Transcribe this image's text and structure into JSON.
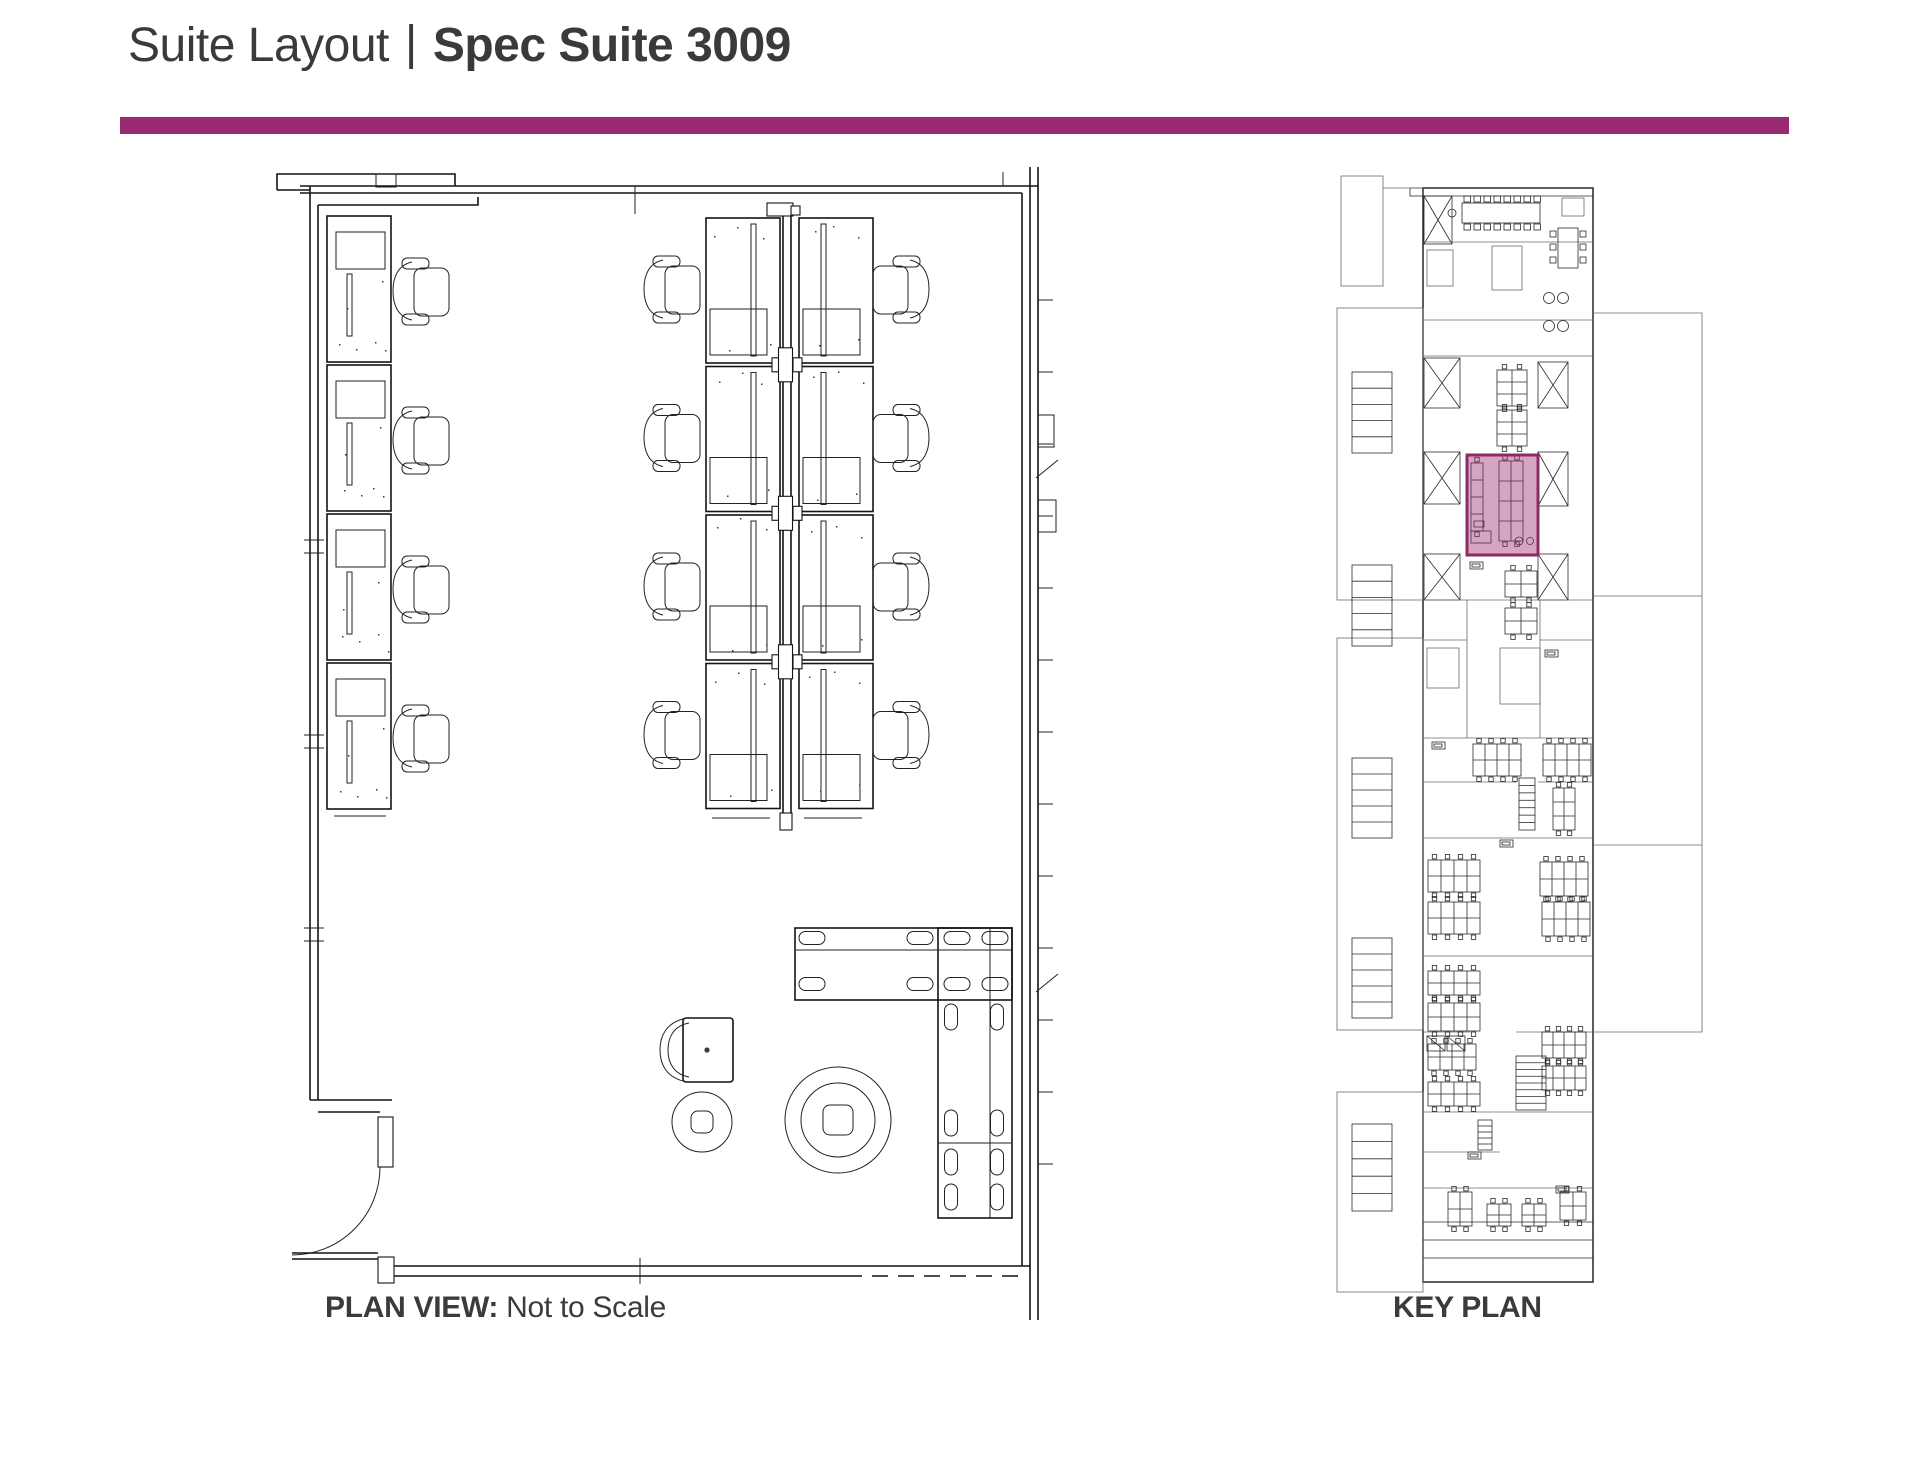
{
  "header": {
    "title_regular": "Suite Layout",
    "separator": "|",
    "title_bold": "Spec Suite 3009",
    "accent_color": "#982B72",
    "title_color": "#3A3A3C"
  },
  "plan_view": {
    "caption_bold": "PLAN VIEW:",
    "caption_text": " Not to Scale",
    "left_desks": {
      "count": 4,
      "x": 327,
      "y0": 216,
      "w": 64,
      "h": 146,
      "pitch": 149
    },
    "left_chairs": {
      "cx": 427,
      "cy0": 292,
      "pitch": 149,
      "count": 4
    },
    "bench_cluster": {
      "rows": 4,
      "y0": 218,
      "h": 145,
      "pitch": 148.5,
      "left_x": 706,
      "right_x": 799,
      "w": 74,
      "divider_x": [
        783,
        791
      ],
      "chair_left_cx": 678,
      "chair_right_cx": 895
    },
    "tables": {
      "horizontal": {
        "x": 795,
        "y": 928,
        "w": 217,
        "h": 72
      },
      "vertical": {
        "x": 938,
        "y": 928,
        "w": 74,
        "h": 290
      },
      "inner_lines": [
        [
          795,
          950,
          1012,
          950
        ],
        [
          990,
          928,
          990,
          1218
        ],
        [
          938,
          1143,
          1012,
          1143
        ]
      ],
      "seat_pills_h": {
        "cx": [
          812,
          920,
          957,
          995
        ],
        "cy": [
          938,
          984
        ]
      },
      "seat_pills_v": {
        "cx": [
          951,
          997
        ],
        "cy": [
          1017,
          1123,
          1162,
          1197
        ]
      }
    },
    "round_tables": [
      {
        "cx": 838,
        "cy": 1120,
        "r_outer": 53,
        "r_inner": 37,
        "square": 30
      },
      {
        "cx": 702,
        "cy": 1122,
        "r_outer": 30,
        "r_inner": 0,
        "square": 22
      }
    ],
    "lounge_chair": {
      "x": 683,
      "y": 1018,
      "w": 50,
      "h": 64
    }
  },
  "key_plan": {
    "caption": "KEY PLAN",
    "highlight": {
      "x": 1467,
      "y": 455,
      "w": 71,
      "h": 100,
      "fill": "rgba(152,43,114,0.42)",
      "stroke": "#8D2B65",
      "stroke_width": 3
    },
    "building": {
      "x": 1423,
      "y": 188,
      "w": 170,
      "h": 1094
    },
    "outrigger": [
      1341,
      176,
      42,
      110
    ],
    "louver_frames": [
      [
        1337,
        308,
        86,
        292
      ],
      [
        1337,
        638,
        86,
        392
      ],
      [
        1337,
        1092,
        86,
        200
      ]
    ],
    "louvers": [
      [
        1352,
        372,
        40,
        81
      ],
      [
        1352,
        565,
        40,
        81
      ],
      [
        1352,
        758,
        40,
        80
      ],
      [
        1352,
        938,
        40,
        80
      ],
      [
        1352,
        1124,
        40,
        87
      ]
    ],
    "right_wing": {
      "x": 1593,
      "y": 313,
      "w": 109,
      "h": 719,
      "divisions": [
        596,
        845
      ]
    },
    "x_cores": [
      [
        1424,
        196,
        28,
        48
      ],
      [
        1424,
        358,
        36,
        50
      ],
      [
        1424,
        452,
        36,
        52
      ],
      [
        1424,
        554,
        36,
        46
      ],
      [
        1538,
        362,
        30,
        46
      ],
      [
        1538,
        452,
        30,
        54
      ],
      [
        1538,
        554,
        30,
        46
      ]
    ],
    "stairs": [
      [
        1519,
        778,
        16,
        52,
        7
      ],
      [
        1516,
        1056,
        30,
        54,
        8
      ],
      [
        1478,
        1120,
        14,
        30,
        5
      ]
    ],
    "elevators": [
      [
        1427,
        1036,
        18,
        15
      ],
      [
        1447,
        1036,
        18,
        15
      ]
    ],
    "wall_segments": [
      [
        1423,
        242,
        1593,
        242
      ],
      [
        1423,
        320,
        1593,
        320
      ],
      [
        1423,
        356,
        1593,
        356
      ],
      [
        1423,
        600,
        1593,
        600
      ],
      [
        1467,
        600,
        1467,
        738
      ],
      [
        1540,
        600,
        1540,
        738
      ],
      [
        1423,
        640,
        1467,
        640
      ],
      [
        1540,
        640,
        1593,
        640
      ],
      [
        1423,
        738,
        1593,
        738
      ],
      [
        1423,
        782,
        1516,
        782
      ],
      [
        1538,
        782,
        1593,
        782
      ],
      [
        1423,
        838,
        1593,
        838
      ],
      [
        1423,
        956,
        1593,
        956
      ],
      [
        1423,
        1032,
        1470,
        1032
      ],
      [
        1516,
        1032,
        1593,
        1032
      ],
      [
        1423,
        1112,
        1593,
        1112
      ],
      [
        1423,
        1152,
        1500,
        1152
      ],
      [
        1423,
        1188,
        1593,
        1188
      ]
    ],
    "clusters": [
      [
        1497,
        370,
        2,
        3,
        15,
        12
      ],
      [
        1497,
        410,
        2,
        3,
        15,
        12
      ],
      [
        1505,
        571,
        2,
        2,
        16,
        13
      ],
      [
        1505,
        608,
        2,
        2,
        16,
        13
      ],
      [
        1473,
        744,
        4,
        2,
        12,
        16
      ],
      [
        1543,
        744,
        4,
        2,
        12,
        16
      ],
      [
        1553,
        788,
        2,
        3,
        11,
        14
      ],
      [
        1428,
        860,
        4,
        2,
        13,
        16
      ],
      [
        1428,
        902,
        4,
        2,
        13,
        16
      ],
      [
        1428,
        971,
        4,
        2,
        13,
        12
      ],
      [
        1428,
        1003,
        4,
        2,
        13,
        14
      ],
      [
        1428,
        1044,
        4,
        2,
        12,
        13
      ],
      [
        1428,
        1082,
        4,
        2,
        13,
        12
      ],
      [
        1540,
        862,
        4,
        2,
        12,
        17
      ],
      [
        1542,
        902,
        4,
        2,
        12,
        17
      ],
      [
        1542,
        1032,
        4,
        2,
        11,
        13
      ],
      [
        1542,
        1066,
        4,
        2,
        11,
        12
      ],
      [
        1448,
        1192,
        2,
        2,
        12,
        17
      ],
      [
        1487,
        1204,
        2,
        2,
        12,
        11
      ],
      [
        1522,
        1204,
        2,
        2,
        12,
        11
      ],
      [
        1560,
        1192,
        2,
        2,
        13,
        14
      ],
      [
        1471,
        463,
        1,
        4,
        12,
        17
      ],
      [
        1499,
        461,
        2,
        4,
        12,
        20
      ]
    ],
    "conference": {
      "table": [
        1462,
        203,
        78,
        20
      ],
      "chairs_per_side": 8,
      "end_dot": [
        1452,
        213
      ]
    },
    "meeting_table": {
      "rect": [
        1558,
        228,
        20,
        40
      ],
      "chairs_per_side": 3
    },
    "lounge_dots": [
      [
        1549,
        298
      ],
      [
        1563,
        298
      ],
      [
        1549,
        326
      ],
      [
        1563,
        326
      ]
    ],
    "rooms": [
      [
        1492,
        246,
        30,
        44
      ],
      [
        1427,
        250,
        26,
        36
      ],
      [
        1562,
        198,
        22,
        18
      ],
      [
        1500,
        648,
        40,
        56
      ],
      [
        1427,
        648,
        32,
        40
      ]
    ],
    "label_boxes": [
      [
        1470,
        562
      ],
      [
        1500,
        840
      ],
      [
        1468,
        1152
      ],
      [
        1556,
        1186
      ],
      [
        1545,
        650
      ],
      [
        1432,
        742
      ]
    ],
    "mini_suite": {
      "rects": [
        [
          1471,
          531,
          20,
          12
        ],
        [
          1474,
          521,
          10,
          6
        ]
      ],
      "dots": [
        [
          1519,
          541,
          4
        ],
        [
          1530,
          541,
          3.5
        ]
      ]
    },
    "bottom_stripes": [
      1222,
      1240,
      1258
    ]
  }
}
